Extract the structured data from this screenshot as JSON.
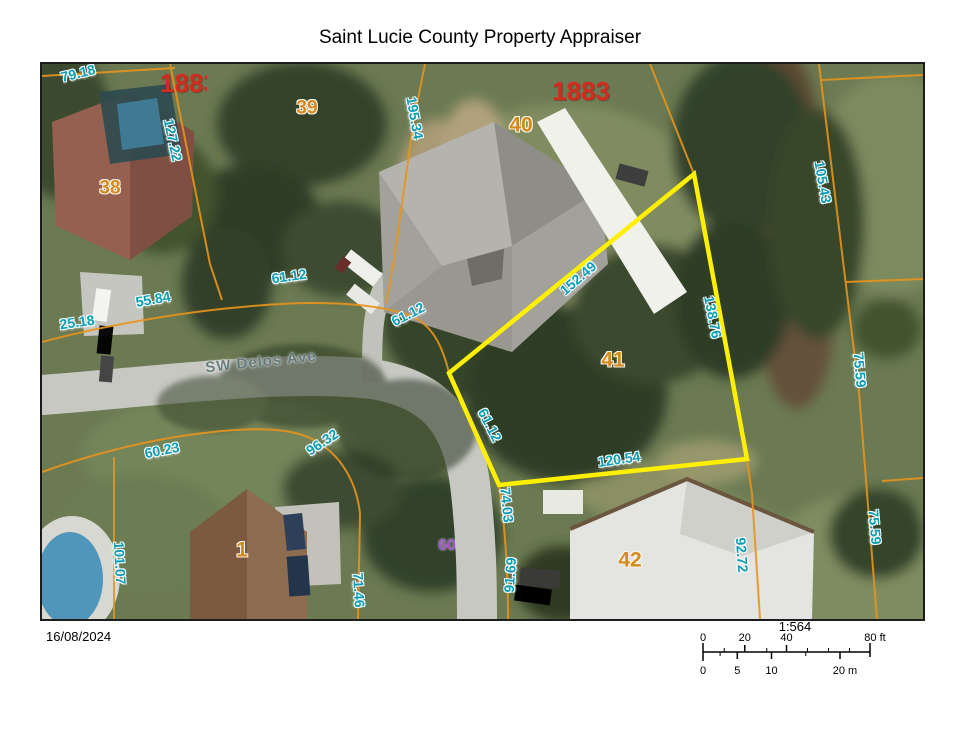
{
  "header": {
    "title": "Saint Lucie County Property Appraiser"
  },
  "map": {
    "street": "SW Delos Ave",
    "parcels": {
      "p1": "1",
      "p38": "38",
      "p39": "39",
      "p40": "40",
      "p41": "41",
      "p42": "42",
      "p60": "60"
    },
    "plats": {
      "left": "1883",
      "right": "1883"
    },
    "dims": {
      "d79_18": "79.18",
      "d127_22": "127.22",
      "d195_34": "195.34",
      "d61_12a": "61.12",
      "d55_84": "55.84",
      "d25_18": "25.18",
      "d61_12b": "61.12",
      "d152_49": "152.49",
      "d138_76": "138.76",
      "d105_43": "105.43",
      "d75_59a": "75.59",
      "d75_59b": "75.59",
      "d92_72": "92.72",
      "d120_54": "120.54",
      "d61_12c": "61.12",
      "d74_03": "74.03",
      "d91_69": "91.69",
      "d60_23": "60.23",
      "d96_32": "96.32",
      "d101_07": "101.07",
      "d71_46": "71.46"
    },
    "colors": {
      "dimension_text": "#0f9db4",
      "parcel_text": "#d58a1f",
      "plat_text": "#d32b1f",
      "lot60_text": "#9b59c8",
      "street_text": "#647b7e",
      "parcel_line": "#e8941c",
      "highlight_outline": "#fff000"
    }
  },
  "footer": {
    "date": "16/08/2024",
    "scale_ratio": "1:564",
    "scalebar": {
      "ft": [
        "0",
        "20",
        "40",
        "80 ft"
      ],
      "m": [
        "0",
        "5",
        "10",
        "20 m"
      ]
    }
  }
}
